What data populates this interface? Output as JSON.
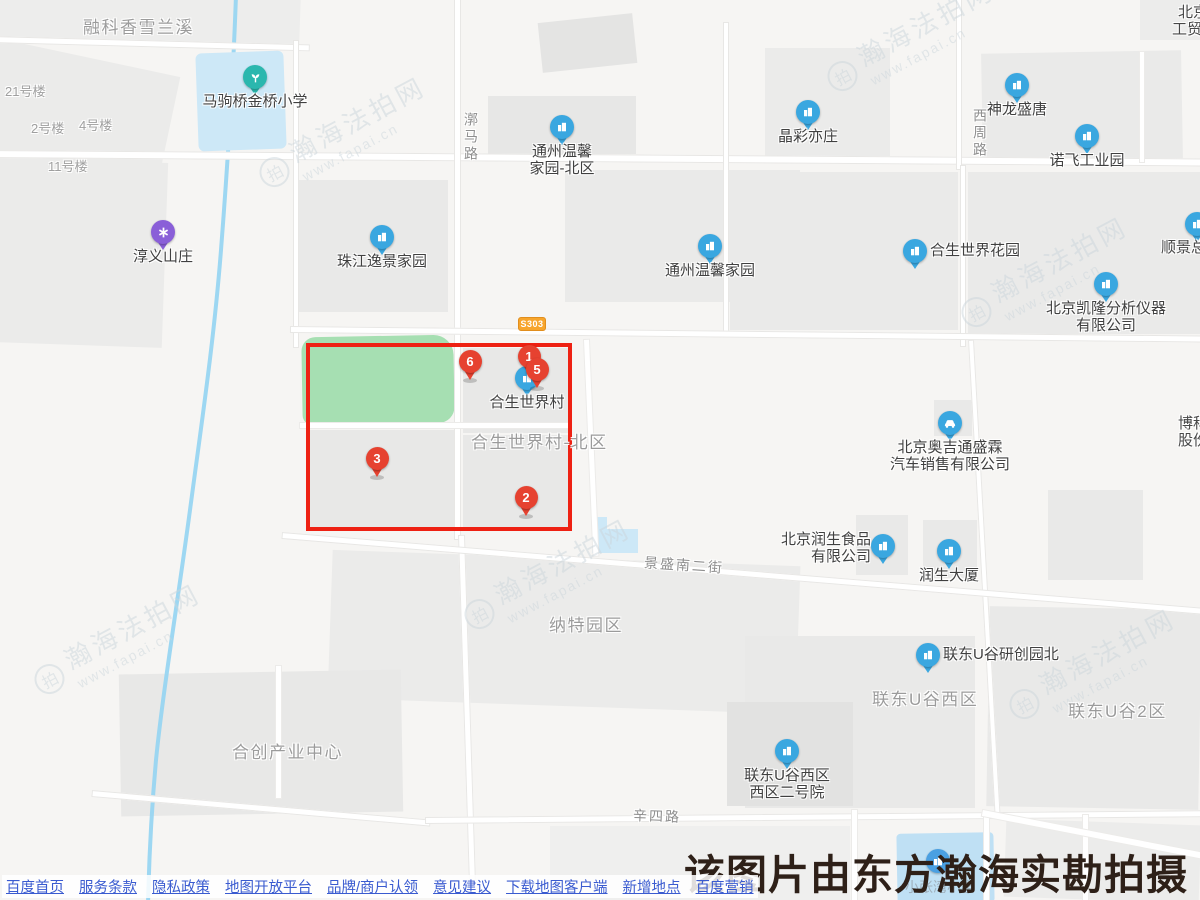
{
  "map": {
    "watermark": {
      "text": "瀚海法拍网",
      "url": "www.fapai.cn",
      "logo_char": "拍"
    },
    "road_shield": "S303",
    "caption": "该图片由东方瀚海实勘拍摄",
    "area_labels": {
      "rongke": "融科香雪兰溪",
      "hesheng_north": "合生世界村-北区",
      "nate": "纳特园区",
      "liandong_west": "联东U谷西区",
      "liandong_2": "联东U谷2区",
      "hechuang": "合创产业中心"
    },
    "building_labels": {
      "b21": "21号楼",
      "b2": "2号楼",
      "b4": "4号楼",
      "b11": "11号楼"
    },
    "road_labels": {
      "huoma": "漷马路",
      "xizhou": "西周路",
      "jingsheng": "景盛南二街",
      "xinsi": "辛四路"
    },
    "edge_labels": {
      "beijing": "北京",
      "gongmao": "工贸",
      "boke": "博科",
      "gufen": "股份",
      "shunjing": "顺景总部"
    },
    "pois": {
      "majuqiao_school": {
        "label": "马驹桥金桥小学"
      },
      "chunyi_villa": {
        "label": "淳义山庄"
      },
      "zhujiang_yijing": {
        "label": "珠江逸景家园"
      },
      "tz_wenxin_north": {
        "lines": [
          "通州温馨",
          "家园-北区"
        ]
      },
      "tz_wenxin": {
        "label": "通州温馨家园"
      },
      "jingcai_yizhuang": {
        "label": "晶彩亦庄"
      },
      "shenlong_shengtang": {
        "label": "神龙盛唐"
      },
      "nuofei_industrial": {
        "label": "诺飞工业园"
      },
      "hesheng_garden": {
        "label": "合生世界花园"
      },
      "kailong": {
        "lines": [
          "北京凯隆分析仪器",
          "有限公司"
        ]
      },
      "hesheng_village": {
        "label": "合生世界村"
      },
      "aojitong": {
        "lines": [
          "北京奥吉通盛霖",
          "汽车销售有限公司"
        ]
      },
      "runsheng_food": {
        "lines": [
          "北京润生食品",
          "有限公司"
        ]
      },
      "runsheng_tower": {
        "label": "润生大厦"
      },
      "liandong_research_north": {
        "label": "联东U谷研创园北"
      },
      "liandong_no2_yard": {
        "lines": [
          "联东U谷西区",
          "西区二号院"
        ]
      },
      "xiaozhangwan_school": {
        "label": "小张湾小学"
      }
    },
    "pins": {
      "p1": "1",
      "p2": "2",
      "p3": "3",
      "p5": "5",
      "p6": "6"
    },
    "footer_links": [
      "百度首页",
      "服务条款",
      "隐私政策",
      "地图开放平台",
      "品牌/商户认领",
      "意见建议",
      "下载地图客户端",
      "新增地点",
      "百度营销"
    ],
    "colors": {
      "pin_red": "#e64230",
      "select_rect_red": "#ee2113",
      "poi_blue": "#3aa7e0",
      "poi_teal": "#2bb7ae",
      "poi_purple": "#8a5fd8",
      "link_blue": "#3a5bd0",
      "park_green": "#a6dfb2",
      "water_blue": "#cde8f7"
    }
  }
}
